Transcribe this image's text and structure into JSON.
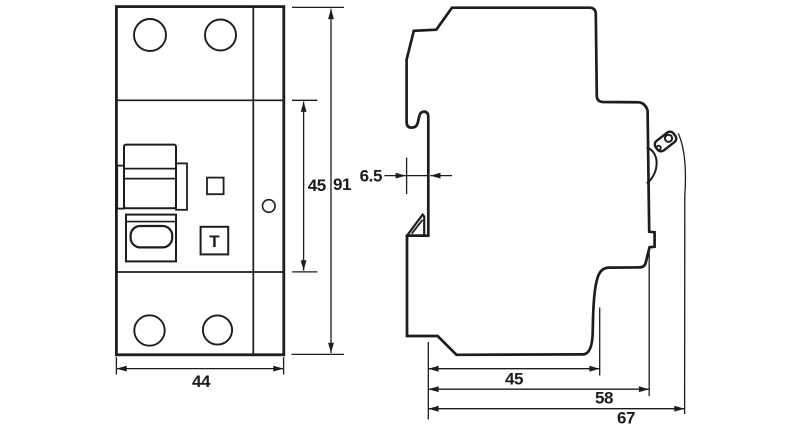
{
  "drawing": {
    "type": "dimensional drawing, DIN-rail modular device (RCD/RCBO), front and side views",
    "units": "mm",
    "line_color": "#1d1d1d",
    "background": "#ffffff"
  },
  "front_view": {
    "name": "front view",
    "test_button": "T",
    "dim_width": "44",
    "dim_height_inner": "45",
    "dim_height_overall": "91"
  },
  "side_view": {
    "name": "side view",
    "dim_rail_depth": "6.5",
    "dim_depth_inner": "45",
    "dim_depth_mid": "58",
    "dim_depth_overall": "67"
  }
}
